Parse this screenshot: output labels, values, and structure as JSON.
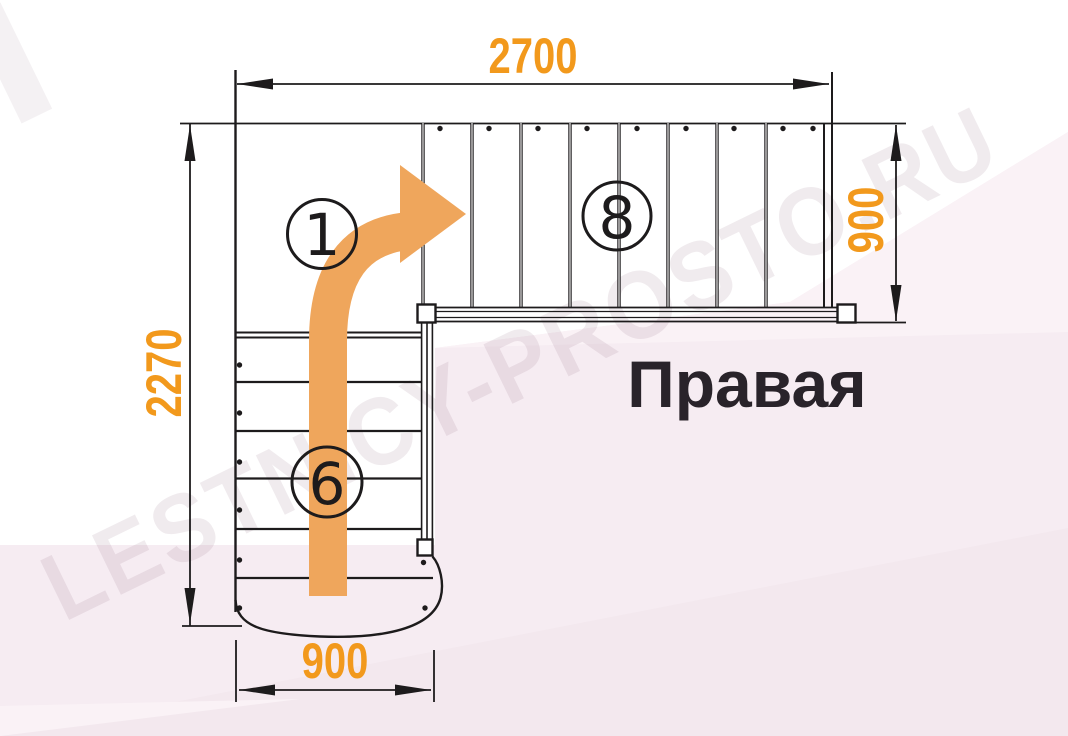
{
  "title": "Правая",
  "watermark": "LESTNICY-PROSTO.RU",
  "dimensions": {
    "top_width_mm": "2700",
    "left_height_mm": "2270",
    "right_flight_width_mm": "900",
    "bottom_flight_width_mm": "900"
  },
  "step_labels": {
    "start": "1",
    "upper_flight": "8",
    "lower_flight": "6"
  },
  "colors": {
    "dimension_text": "#F2991C",
    "direction_arrow": "#EFA65C",
    "drawing_lines": "#1D1B1C",
    "watermark_pink": "#F6ECF2"
  },
  "diagram": {
    "type": "staircase-plan-top-view",
    "turn_direction": "right",
    "upper_flight_steps": 8,
    "lower_flight_steps": 6,
    "has_quarter_landing": true,
    "rounded_starting_step": true
  }
}
